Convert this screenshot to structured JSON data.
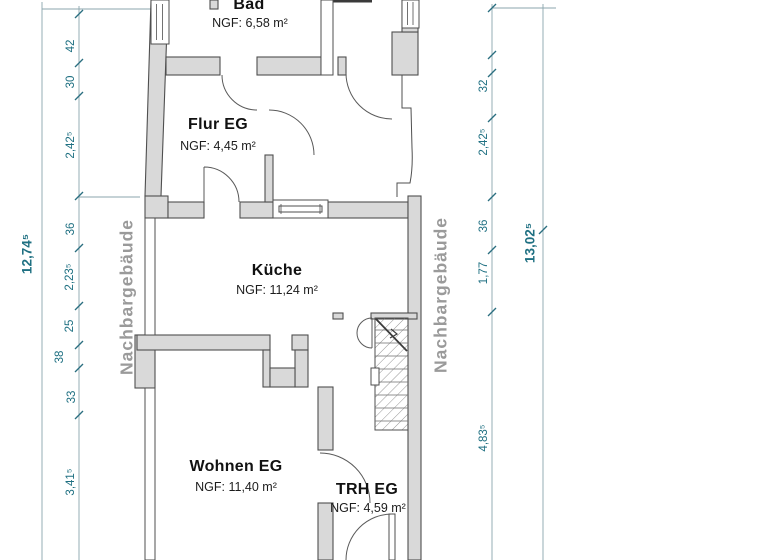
{
  "plan": {
    "rooms": [
      {
        "id": "bad",
        "name": "Bad",
        "area": "NGF: 6,58 m²"
      },
      {
        "id": "flur",
        "name": "Flur EG",
        "area": "NGF: 4,45 m²"
      },
      {
        "id": "kueche",
        "name": "Küche",
        "area": "NGF: 11,24 m²"
      },
      {
        "id": "wohnen",
        "name": "Wohnen EG",
        "area": "NGF: 11,40 m²"
      },
      {
        "id": "trh",
        "name": "TRH EG",
        "area": "NGF: 4,59 m²"
      }
    ],
    "neighbor_label_left": "Nachbargebäude",
    "neighbor_label_right": "Nachbargebäude",
    "dimensions": {
      "left_total": "12,74⁵",
      "right_total": "13,02⁵",
      "left_chain": [
        "42",
        "30",
        "2,42⁵",
        "36",
        "2,23⁵",
        "25",
        "38",
        "33",
        "3,41⁵"
      ],
      "right_chain": [
        "32",
        "2,42⁵",
        "36",
        "1,77",
        "4,83⁵"
      ]
    },
    "colors": {
      "dimension_text": "#1f7082",
      "dim_line": "#8ba6ae",
      "wall_fill": "#d9d9d9",
      "wall_stroke": "#4f4f4f",
      "neighbor_text": "#9a9a9a"
    }
  }
}
